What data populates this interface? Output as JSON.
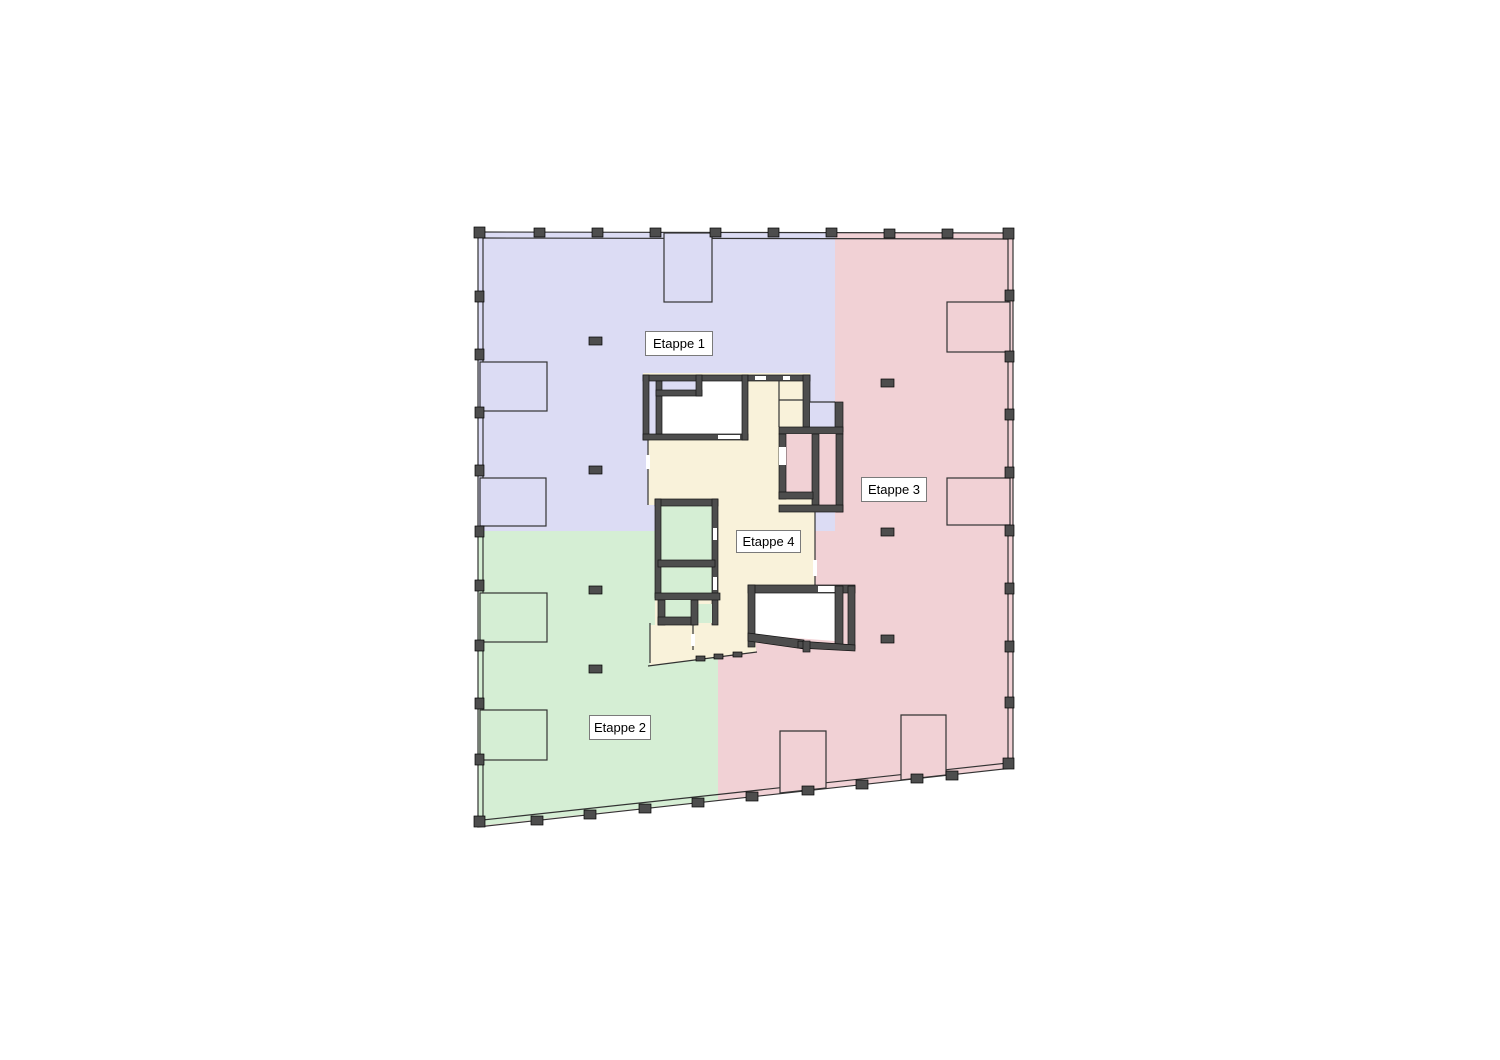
{
  "labels": {
    "e1": "Etappe 1",
    "e2": "Etappe 2",
    "e3": "Etappe 3",
    "e4": "Etappe 4"
  },
  "colors": {
    "etappe1": "#dcdcf4",
    "etappe2": "#d5eed4",
    "etappe3": "#f1d1d5",
    "etappe4": "#f9f2da",
    "wall": "#4d4d4d",
    "line": "#333333",
    "room_white": "#ffffff",
    "label_border": "#7a7a7a",
    "background": "#ffffff"
  }
}
